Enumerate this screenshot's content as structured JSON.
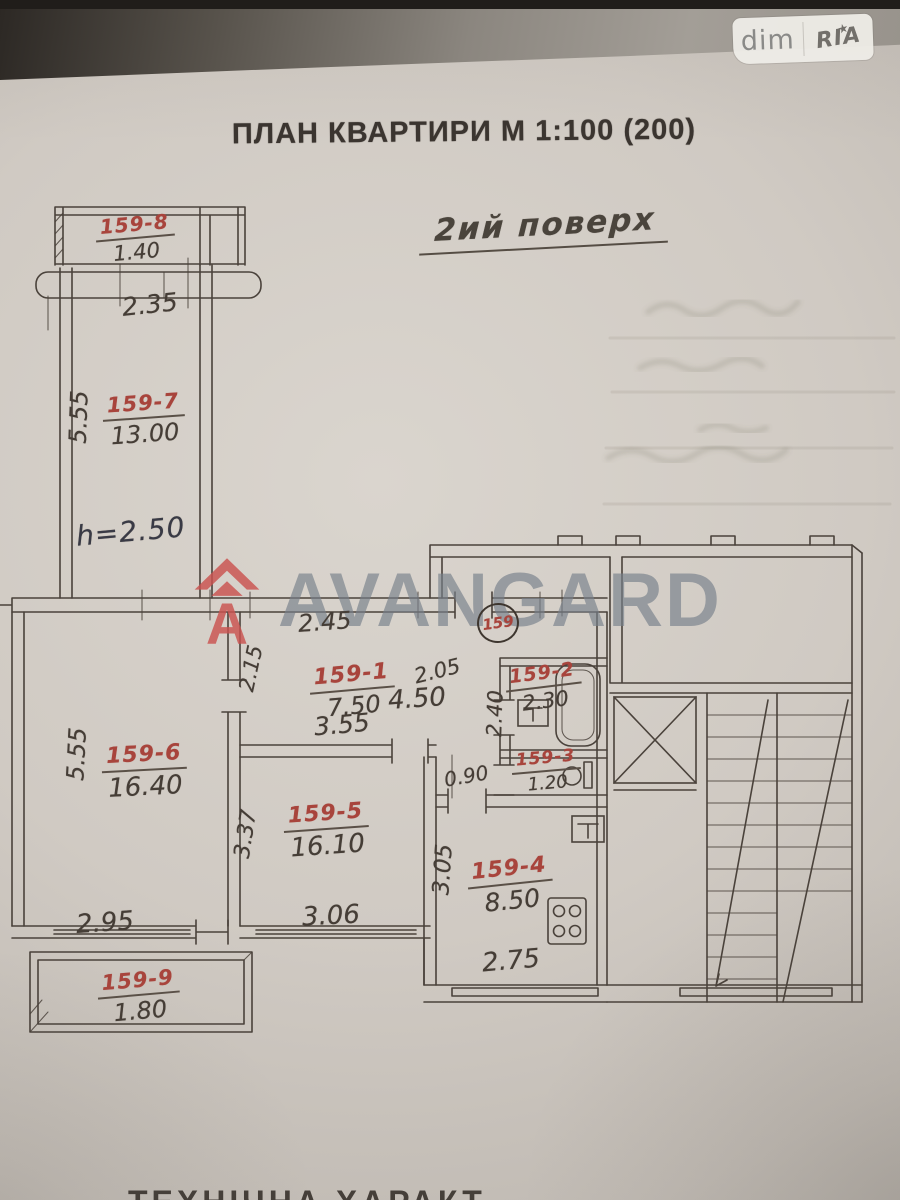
{
  "photo": {
    "badge": {
      "dim": "dim",
      "ria": "RIA",
      "star": "★"
    },
    "title": "ПЛАН КВАРТИРИ М 1:100 (200)",
    "floor_note": "2ий поверх",
    "footer_partial": "ТЕХНІЧНА ХАРАКТ"
  },
  "plan": {
    "apartment_number": "159",
    "height_note": "h=2.50",
    "rooms": {
      "r1": {
        "label": "159-1",
        "area": "7.50"
      },
      "r2": {
        "label": "159-2",
        "area": "2.30"
      },
      "r3": {
        "label": "159-3",
        "area": "1.20"
      },
      "r4": {
        "label": "159-4",
        "area": "8.50"
      },
      "r5": {
        "label": "159-5",
        "area": "16.10"
      },
      "r6": {
        "label": "159-6",
        "area": "16.40"
      },
      "r7": {
        "label": "159-7",
        "area": "13.00"
      },
      "r8": {
        "label": "159-8",
        "area": "1.40"
      },
      "r9": {
        "label": "159-9",
        "area": "1.80"
      }
    },
    "dims": {
      "d2_35": "2.35",
      "d5_55_top": "5.55",
      "d5_55_mid": "5.55",
      "d2_45": "2.45",
      "d2_15": "2.15",
      "d3_55": "3.55",
      "d4_50": "4.50",
      "d2_05": "2.05",
      "d2_40": "2.40",
      "d0_90": "0.90",
      "d3_37": "3.37",
      "d3_06": "3.06",
      "d3_05": "3.05",
      "d2_75": "2.75",
      "d2_95": "2.95"
    }
  },
  "watermark": {
    "text": "AVANGARD",
    "logo_letter": "A"
  },
  "colors": {
    "pencil": "#4a423b",
    "red_ink": "#a8443c",
    "blue_ink": "#3b4570",
    "watermark_gray": "#777f8a",
    "watermark_red": "#cb5350",
    "paper": "#d0cac3"
  }
}
